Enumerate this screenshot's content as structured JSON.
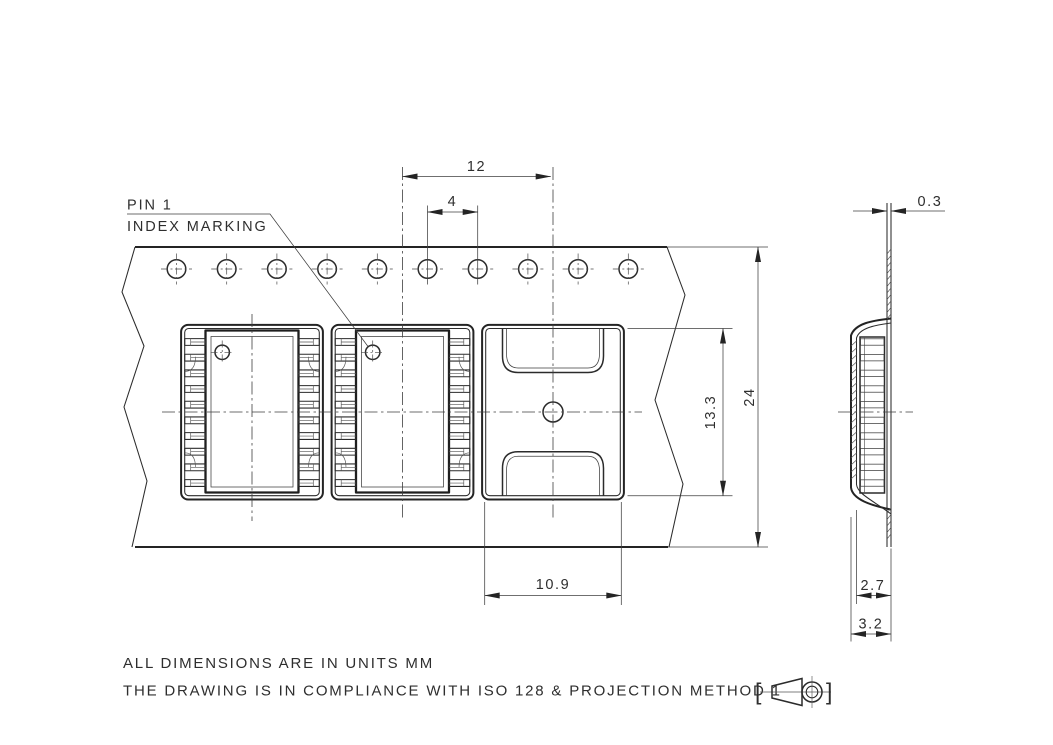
{
  "meta": {
    "drawing_type": "carrier-tape-dimension-drawing",
    "background_color": "#ffffff",
    "line_color": "#242424",
    "projection_symbol": "first-angle-projection"
  },
  "labels": {
    "pin1_line1": "PIN 1",
    "pin1_line2": "INDEX MARKING"
  },
  "dimensions": {
    "pocket_pitch": "12",
    "sprocket_pitch": "4",
    "pocket_length": "13.3",
    "tape_width": "24",
    "pocket_width": "10.9",
    "tape_thickness": "0.3",
    "pocket_depth_inner": "2.7",
    "pocket_depth_overall": "3.2"
  },
  "notes": {
    "line1": "ALL DIMENSIONS ARE IN UNITS MM",
    "line2": "THE DRAWING IS IN COMPLIANCE WITH ISO 128 & PROJECTION METHOD 1",
    "bracket_open": "[",
    "bracket_close": "]"
  },
  "structure": {
    "sprocket_hole_count": 10,
    "pocket_count": 3,
    "loaded_pocket_count": 2,
    "leads_per_side": 10
  }
}
